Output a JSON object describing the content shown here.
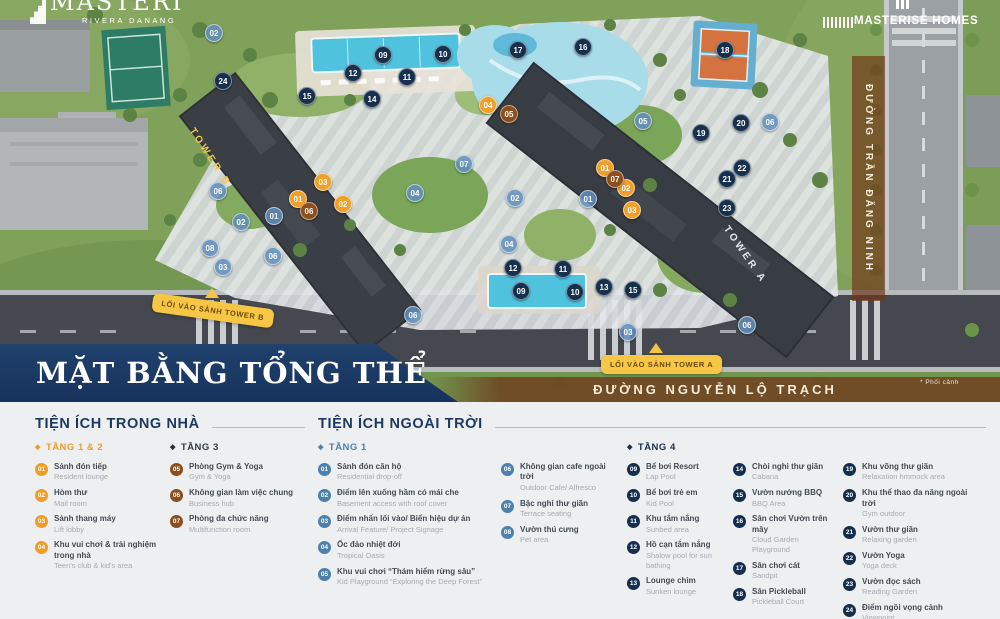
{
  "brand": {
    "logo_main": "MASTERI",
    "logo_sub": "RIVERA DANANG",
    "logo_right": "MASTERISE HOMES"
  },
  "map": {
    "title": "MẶT BẰNG TỔNG THỂ",
    "road_right": "ĐƯỜNG TRẦN ĐĂNG NINH",
    "road_bottom": "ĐƯỜNG NGUYỄN LỘ TRẠCH",
    "entry_a": "LỐI VÀO SẢNH TOWER A",
    "entry_b": "LỐI VÀO SẢNH TOWER B",
    "tower_a": "TOWER A",
    "tower_b": "TOWER B",
    "note": "* Phối cảnh",
    "markers": [
      {
        "n": "09",
        "c": "n",
        "x": 383,
        "y": 55
      },
      {
        "n": "10",
        "c": "n",
        "x": 443,
        "y": 54
      },
      {
        "n": "12",
        "c": "n",
        "x": 353,
        "y": 73
      },
      {
        "n": "11",
        "c": "n",
        "x": 407,
        "y": 77
      },
      {
        "n": "24",
        "c": "n",
        "x": 223,
        "y": 81
      },
      {
        "n": "15",
        "c": "n",
        "x": 307,
        "y": 96
      },
      {
        "n": "14",
        "c": "n",
        "x": 372,
        "y": 99
      },
      {
        "n": "17",
        "c": "n",
        "x": 518,
        "y": 50
      },
      {
        "n": "16",
        "c": "n",
        "x": 583,
        "y": 47
      },
      {
        "n": "18",
        "c": "n",
        "x": 725,
        "y": 50
      },
      {
        "n": "20",
        "c": "n",
        "x": 741,
        "y": 123
      },
      {
        "n": "19",
        "c": "n",
        "x": 701,
        "y": 133
      },
      {
        "n": "22",
        "c": "n",
        "x": 742,
        "y": 168
      },
      {
        "n": "21",
        "c": "n",
        "x": 727,
        "y": 179
      },
      {
        "n": "23",
        "c": "n",
        "x": 727,
        "y": 208
      },
      {
        "n": "12",
        "c": "n",
        "x": 513,
        "y": 268
      },
      {
        "n": "11",
        "c": "n",
        "x": 563,
        "y": 269
      },
      {
        "n": "09",
        "c": "n",
        "x": 521,
        "y": 291
      },
      {
        "n": "10",
        "c": "n",
        "x": 575,
        "y": 292
      },
      {
        "n": "13",
        "c": "n",
        "x": 604,
        "y": 287
      },
      {
        "n": "15",
        "c": "n",
        "x": 633,
        "y": 290
      },
      {
        "n": "02",
        "c": "s",
        "x": 214,
        "y": 33
      },
      {
        "n": "05",
        "c": "s",
        "x": 643,
        "y": 121
      },
      {
        "n": "06",
        "c": "s",
        "x": 770,
        "y": 122
      },
      {
        "n": "07",
        "c": "s",
        "x": 464,
        "y": 164
      },
      {
        "n": "04",
        "c": "s",
        "x": 415,
        "y": 193
      },
      {
        "n": "06",
        "c": "s",
        "x": 218,
        "y": 191
      },
      {
        "n": "01",
        "c": "s",
        "x": 274,
        "y": 216
      },
      {
        "n": "02",
        "c": "s",
        "x": 241,
        "y": 222
      },
      {
        "n": "08",
        "c": "s",
        "x": 210,
        "y": 248
      },
      {
        "n": "03",
        "c": "s",
        "x": 223,
        "y": 267
      },
      {
        "n": "06",
        "c": "s",
        "x": 273,
        "y": 256
      },
      {
        "n": "06",
        "c": "s",
        "x": 413,
        "y": 315
      },
      {
        "n": "01",
        "c": "s",
        "x": 588,
        "y": 199
      },
      {
        "n": "02",
        "c": "s",
        "x": 515,
        "y": 198
      },
      {
        "n": "04",
        "c": "s",
        "x": 509,
        "y": 244
      },
      {
        "n": "03",
        "c": "s",
        "x": 628,
        "y": 332
      },
      {
        "n": "06",
        "c": "s",
        "x": 747,
        "y": 325
      },
      {
        "n": "03",
        "c": "o",
        "x": 323,
        "y": 182
      },
      {
        "n": "01",
        "c": "o",
        "x": 298,
        "y": 199
      },
      {
        "n": "02",
        "c": "o",
        "x": 343,
        "y": 204
      },
      {
        "n": "04",
        "c": "o",
        "x": 488,
        "y": 105
      },
      {
        "n": "01",
        "c": "o",
        "x": 605,
        "y": 168
      },
      {
        "n": "02",
        "c": "o",
        "x": 626,
        "y": 188
      },
      {
        "n": "03",
        "c": "o",
        "x": 632,
        "y": 210
      },
      {
        "n": "05",
        "c": "b",
        "x": 509,
        "y": 114
      },
      {
        "n": "06",
        "c": "b",
        "x": 309,
        "y": 211
      },
      {
        "n": "07",
        "c": "b",
        "x": 615,
        "y": 179
      }
    ]
  },
  "legend": {
    "sections": [
      {
        "title": "TIỆN ÍCH TRONG NHÀ",
        "columns": [
          {
            "group": "TẦNG 1 & 2",
            "cls": "orange",
            "width": 135,
            "items": [
              {
                "n": "01",
                "vi": "Sảnh đón tiếp",
                "en": "Resident lounge"
              },
              {
                "n": "02",
                "vi": "Hòm thư",
                "en": "Mail room"
              },
              {
                "n": "03",
                "vi": "Sảnh thang máy",
                "en": "Lift lobby"
              },
              {
                "n": "04",
                "vi": "Khu vui chơi & trải nghiệm trong nhà",
                "en": "Teen's club & kid's area"
              }
            ]
          },
          {
            "group": "TẦNG 3",
            "cls": "brown",
            "width": 135,
            "items": [
              {
                "n": "05",
                "vi": "Phòng Gym & Yoga",
                "en": "Gym & Yoga"
              },
              {
                "n": "06",
                "vi": "Không gian làm việc chung",
                "en": "Business hub"
              },
              {
                "n": "07",
                "vi": "Phòng đa chức năng",
                "en": "Multifunction room"
              }
            ]
          }
        ]
      },
      {
        "title": "TIỆN ÍCH NGOÀI TRỜI",
        "columns": [
          {
            "group": "TẦNG 1",
            "cls": "blue",
            "width": 183,
            "items": [
              {
                "n": "01",
                "vi": "Sảnh đón căn hộ",
                "en": "Residential drop-off"
              },
              {
                "n": "02",
                "vi": "Điểm lên xuống hầm có mái che",
                "en": "Basement access with roof cover"
              },
              {
                "n": "03",
                "vi": "Điểm nhấn lối vào/ Biển hiệu dự án",
                "en": "Arrival Feature/ Project Signage"
              },
              {
                "n": "04",
                "vi": "Ốc đảo nhiệt đới",
                "en": "Tropical Oasis"
              },
              {
                "n": "05",
                "vi": "Khu vui chơi “Thám hiểm rừng sâu”",
                "en": "Kid Playground “Exploring the Deep Forest”"
              }
            ]
          },
          {
            "group": null,
            "cls": "blue",
            "width": 126,
            "items": [
              {
                "n": "06",
                "vi": "Không gian cafe ngoài trời",
                "en": "Outdoor Cafe/ Alfresco"
              },
              {
                "n": "07",
                "vi": "Bậc nghỉ thư giãn",
                "en": "Terrace seating"
              },
              {
                "n": "08",
                "vi": "Vườn thú cưng",
                "en": "Pet area"
              }
            ]
          },
          {
            "group": "TẦNG 4",
            "cls": "navy",
            "width": 106,
            "items": [
              {
                "n": "09",
                "vi": "Bể bơi Resort",
                "en": "Lap Pool"
              },
              {
                "n": "10",
                "vi": "Bể bơi trẻ em",
                "en": "Kid Pool"
              },
              {
                "n": "11",
                "vi": "Khu tắm nắng",
                "en": "Sunbed area"
              },
              {
                "n": "12",
                "vi": "Hồ cạn tắm nắng",
                "en": "Shalow pool for sun bathing"
              },
              {
                "n": "13",
                "vi": "Lounge chìm",
                "en": "Sunken lounge"
              }
            ]
          },
          {
            "group": null,
            "cls": "navy",
            "width": 110,
            "items": [
              {
                "n": "14",
                "vi": "Chòi nghỉ thư giãn",
                "en": "Cabana"
              },
              {
                "n": "15",
                "vi": "Vườn nướng BBQ",
                "en": "BBQ Area"
              },
              {
                "n": "16",
                "vi": "Sân chơi Vườn trên mây",
                "en": "Cloud Garden Playground"
              },
              {
                "n": "17",
                "vi": "Sân chơi cát",
                "en": "Sandpit"
              },
              {
                "n": "18",
                "vi": "Sân Pickleball",
                "en": "Pickleball Court"
              }
            ]
          },
          {
            "group": null,
            "cls": "navy",
            "width": 143,
            "items": [
              {
                "n": "19",
                "vi": "Khu võng thư giãn",
                "en": "Relaxation hmmock area"
              },
              {
                "n": "20",
                "vi": "Khu thể thao đa năng ngoài trời",
                "en": "Gym outdoor"
              },
              {
                "n": "21",
                "vi": "Vườn thư giãn",
                "en": "Relaxing garden"
              },
              {
                "n": "22",
                "vi": "Vườn Yoga",
                "en": "Yoga deck"
              },
              {
                "n": "23",
                "vi": "Vườn đọc sách",
                "en": "Reading Garden"
              },
              {
                "n": "24",
                "vi": "Điểm ngồi vọng cảnh",
                "en": "Viewpoint"
              }
            ]
          }
        ]
      }
    ]
  },
  "colors": {
    "navy": "#16304e",
    "orange": "#ef9d27",
    "brown": "#8d4e1b",
    "blue": "#4d80ad",
    "yellow_label": "#f7c644",
    "road_band": "#70351880",
    "title_block": "#1d3d66",
    "legend_bg": "#edeff1"
  }
}
